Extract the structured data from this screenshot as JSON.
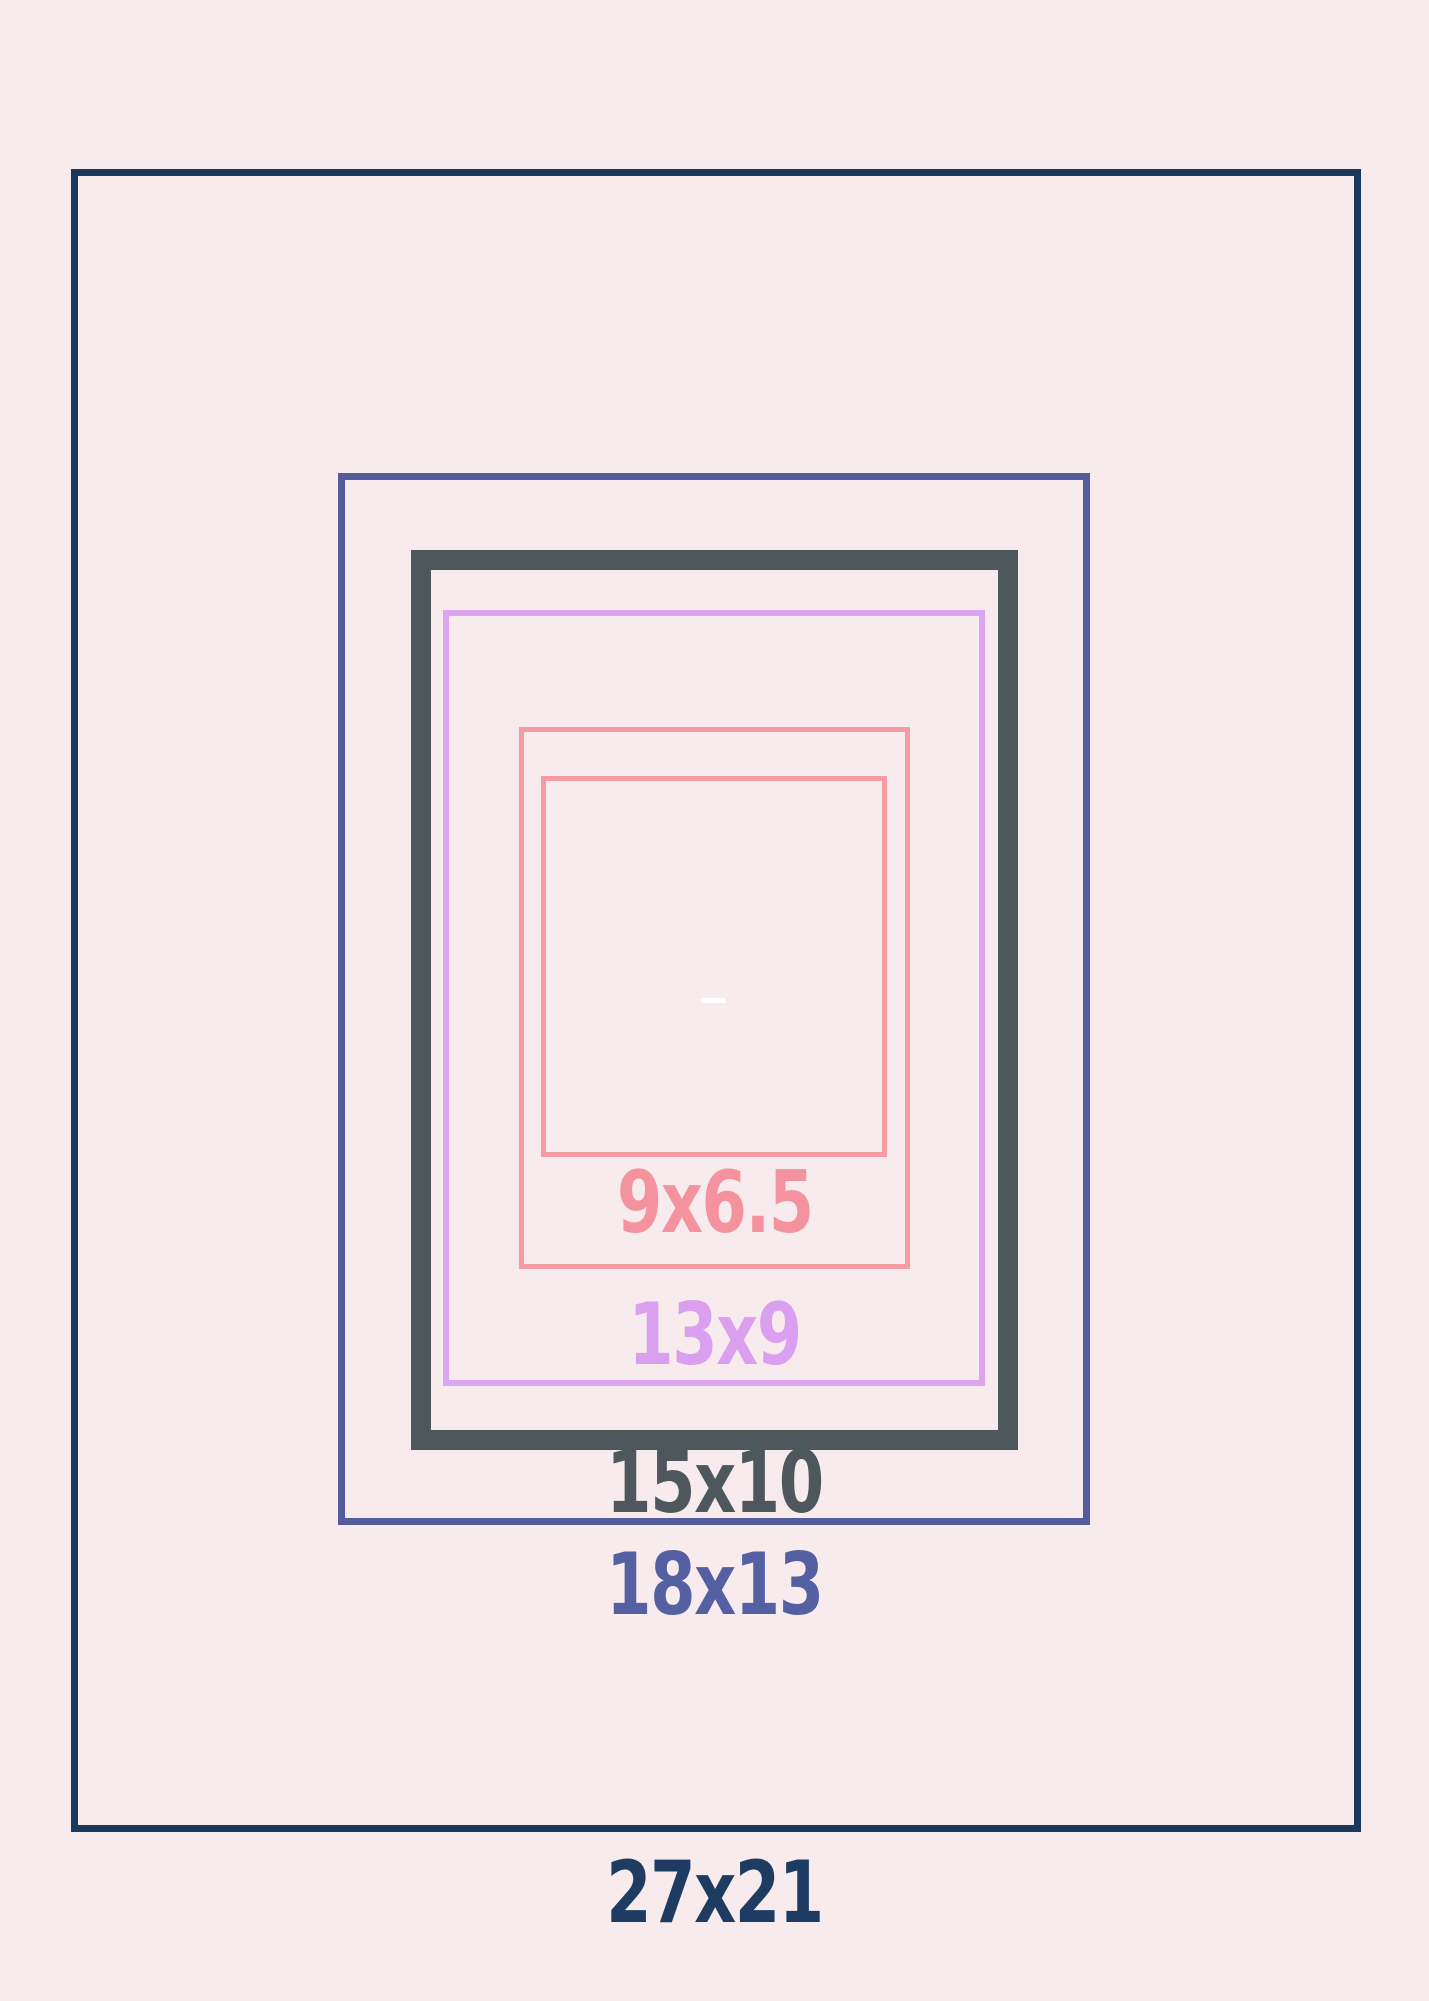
{
  "page": {
    "background": "#f7ebed"
  },
  "diagram": {
    "frames": [
      {
        "label": "27x21",
        "color": "#19395c",
        "label_color": "#1e3c61"
      },
      {
        "label": "18x13",
        "color": "#555c9d",
        "label_color": "#5560a2"
      },
      {
        "label": "15x10",
        "color": "#4e575b",
        "label_color": "#4e575b"
      },
      {
        "label": "13x9",
        "color": "#dba6ef",
        "label_color": "#db9ff0"
      },
      {
        "label": "9x6.5",
        "color": "#f49ba3",
        "label_color": "#f4939d"
      }
    ],
    "center_marker": {
      "color": "#ffffff"
    }
  }
}
